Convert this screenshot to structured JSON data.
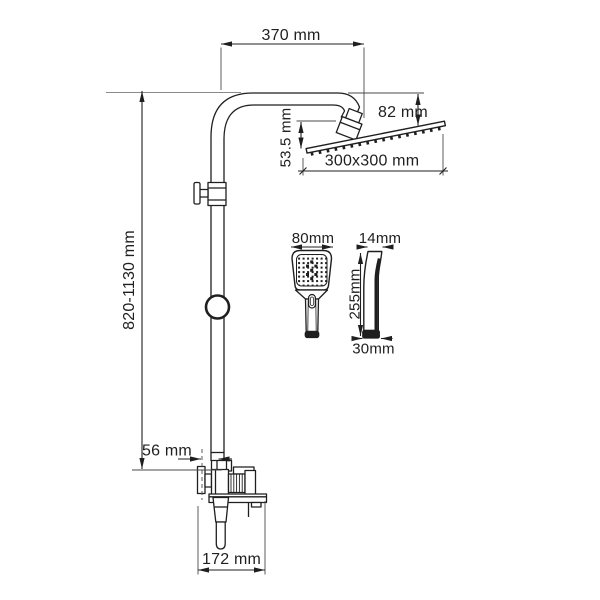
{
  "drawing": {
    "type": "technical-dimension-drawing",
    "subject": "shower-column-with-overhead-shower-hand-shower-and-mixer",
    "unit": "mm",
    "colors": {
      "background": "#ffffff",
      "line": "#1f1f1f"
    },
    "labels": {
      "arm_reach": "370 mm",
      "column_height": "820-1130 mm",
      "head_drop": "82 mm",
      "head_offset": "53.5 mm",
      "head_size": "300x300 mm",
      "hand_shower_width": "80mm",
      "hand_shower_depth": "14mm",
      "hand_shower_length": "255mm",
      "hand_shower_handle_width": "30mm",
      "wall_offset": "56 mm",
      "mixer_span": "172 mm"
    }
  }
}
